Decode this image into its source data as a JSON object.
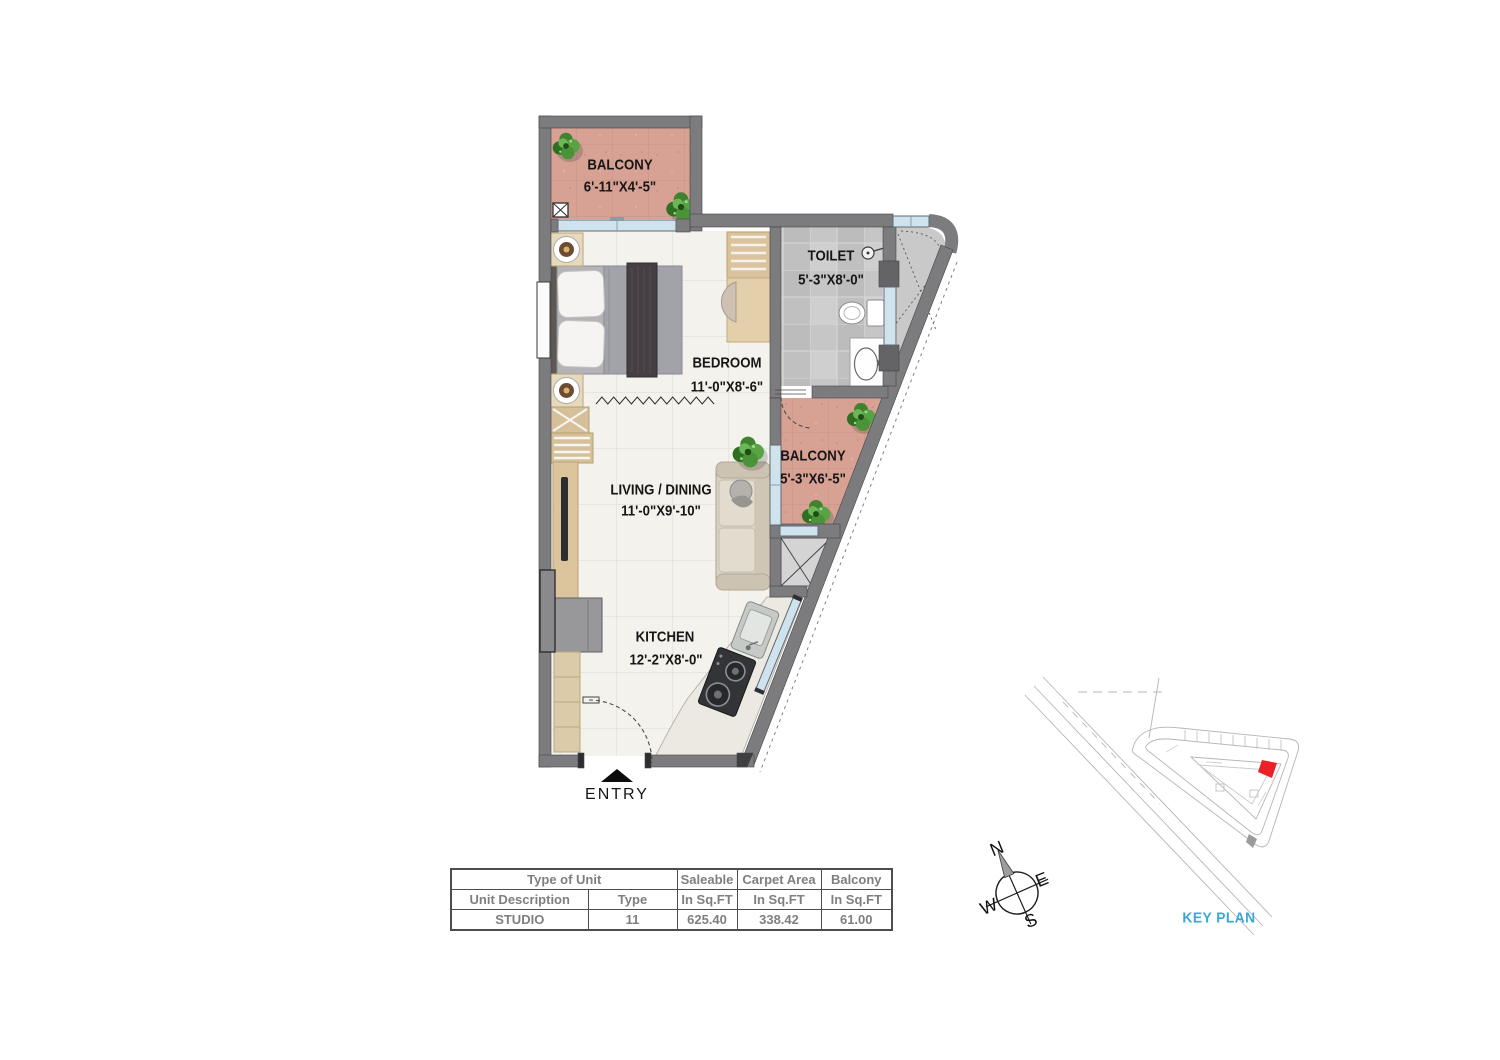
{
  "plan": {
    "rooms": [
      {
        "name": "BALCONY",
        "dims": "6'-11\"X4'-5\""
      },
      {
        "name": "TOILET",
        "dims": "5'-3\"X8'-0\""
      },
      {
        "name": "BEDROOM",
        "dims": "11'-0\"X8'-6\""
      },
      {
        "name": "BALCONY",
        "dims": "5'-3\"X6'-5\""
      },
      {
        "name": "LIVING / DINING",
        "dims": "11'-0\"X9'-10\""
      },
      {
        "name": "KITCHEN",
        "dims": "12'-2\"X8'-0\""
      }
    ],
    "entry_label": "ENTRY"
  },
  "unit_table": {
    "headers": {
      "type_of_unit": "Type of Unit",
      "saleable": "Saleable",
      "carpet_area": "Carpet Area",
      "balcony": "Balcony"
    },
    "subheaders": {
      "unit_description": "Unit Description",
      "type": "Type",
      "in_sqft": "In Sq.FT"
    },
    "values": {
      "unit_description": "STUDIO",
      "type": "11",
      "saleable": "625.40",
      "carpet_area": "338.42",
      "balcony": "61.00"
    }
  },
  "compass": {
    "north": "N",
    "east": "E",
    "west": "W",
    "south": "S"
  },
  "key_plan": {
    "label": "KEY PLAN"
  },
  "colors": {
    "wall": "#7c7c7f",
    "balcony_floor": "#d7a194",
    "main_floor": "#f3f2ed",
    "toilet_floor": "#c6c6c6",
    "glass": "#cfe3ee",
    "keyplan_label": "#3aa7da",
    "unit_highlight": "#ec2027",
    "table_text": "#7f7f7f"
  }
}
